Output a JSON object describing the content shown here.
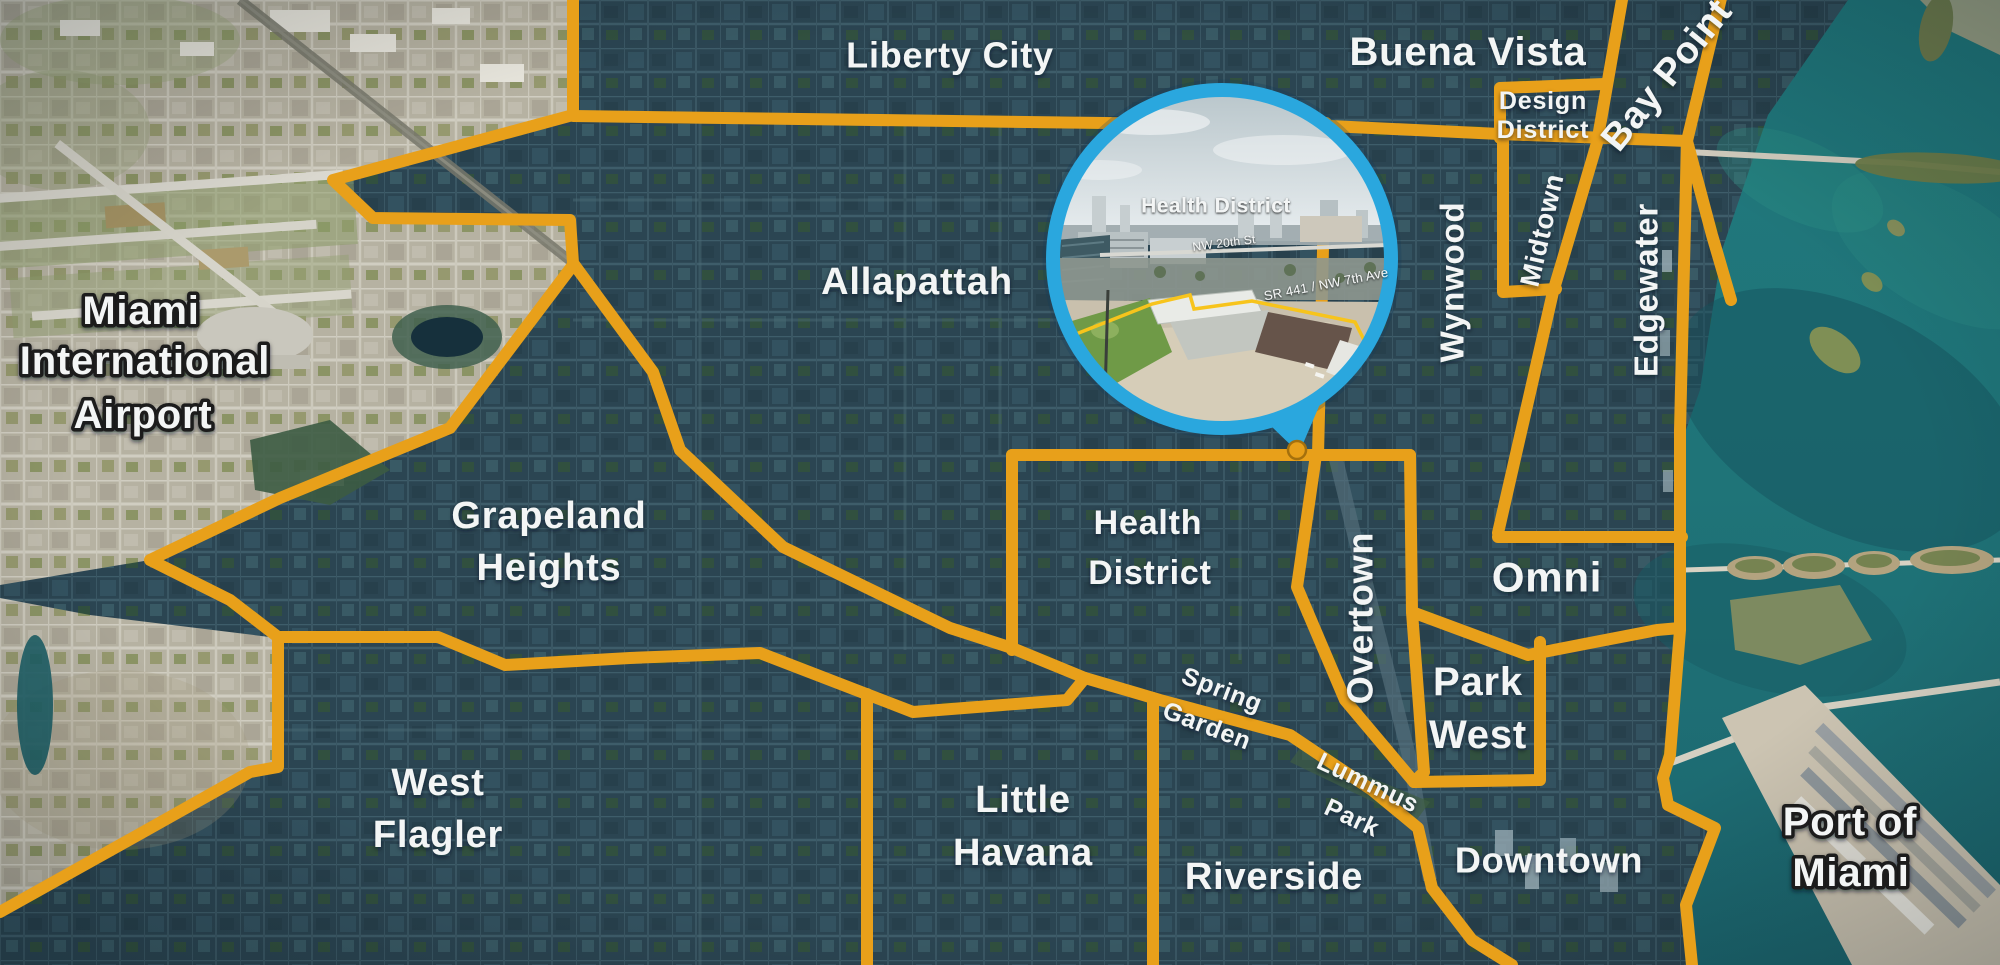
{
  "colors": {
    "boundary": "#E8A01A",
    "pin": "#E8A01A",
    "ring": "#2AA7DE",
    "parcel_outline": "#F7C41C",
    "label_text": "#F3F5F5",
    "water": "#1F7478",
    "city_dark": "#2B4552",
    "city_light": "#B6B2A2"
  },
  "map": {
    "region_labels": [
      {
        "id": "liberty-city",
        "text": "Liberty City",
        "x": 950,
        "y": 55,
        "size": 36,
        "rot": 0,
        "style": "plain"
      },
      {
        "id": "buena-vista",
        "text": "Buena Vista",
        "x": 1468,
        "y": 52,
        "size": 40,
        "rot": 0,
        "style": "plain"
      },
      {
        "id": "design-district-1",
        "text": "Design",
        "x": 1543,
        "y": 101,
        "size": 25,
        "rot": 0,
        "style": "plain"
      },
      {
        "id": "design-district-2",
        "text": "District",
        "x": 1543,
        "y": 130,
        "size": 25,
        "rot": 0,
        "style": "plain"
      },
      {
        "id": "bay-point",
        "text": "Bay Point",
        "x": 1667,
        "y": 75,
        "size": 38,
        "rot": -51,
        "style": "plain"
      },
      {
        "id": "midtown",
        "text": "Midtown",
        "x": 1542,
        "y": 230,
        "size": 27,
        "rot": -77,
        "style": "plain"
      },
      {
        "id": "wynwood",
        "text": "Wynwood",
        "x": 1452,
        "y": 282,
        "size": 33,
        "rot": -90,
        "style": "plain"
      },
      {
        "id": "edgewater",
        "text": "Edgewater",
        "x": 1646,
        "y": 290,
        "size": 33,
        "rot": -90,
        "style": "plain"
      },
      {
        "id": "allapattah",
        "text": "Allapattah",
        "x": 917,
        "y": 282,
        "size": 38,
        "rot": 0,
        "style": "plain"
      },
      {
        "id": "airport-1",
        "text": "Miami",
        "x": 141,
        "y": 311,
        "size": 40,
        "rot": 0,
        "style": "outlined"
      },
      {
        "id": "airport-2",
        "text": "International",
        "x": 145,
        "y": 361,
        "size": 40,
        "rot": 0,
        "style": "outlined"
      },
      {
        "id": "airport-3",
        "text": "Airport",
        "x": 143,
        "y": 415,
        "size": 40,
        "rot": 0,
        "style": "outlined"
      },
      {
        "id": "grapeland-1",
        "text": "Grapeland",
        "x": 549,
        "y": 516,
        "size": 38,
        "rot": 0,
        "style": "plain"
      },
      {
        "id": "grapeland-2",
        "text": "Heights",
        "x": 549,
        "y": 568,
        "size": 38,
        "rot": 0,
        "style": "plain"
      },
      {
        "id": "health-district-1",
        "text": "Health",
        "x": 1148,
        "y": 523,
        "size": 34,
        "rot": 0,
        "style": "plain"
      },
      {
        "id": "health-district-2",
        "text": "District",
        "x": 1150,
        "y": 573,
        "size": 34,
        "rot": 0,
        "style": "plain"
      },
      {
        "id": "overtown",
        "text": "Overtown",
        "x": 1360,
        "y": 618,
        "size": 36,
        "rot": -90,
        "style": "plain"
      },
      {
        "id": "omni",
        "text": "Omni",
        "x": 1547,
        "y": 577,
        "size": 42,
        "rot": 0,
        "style": "plain"
      },
      {
        "id": "park-west-1",
        "text": "Park",
        "x": 1478,
        "y": 682,
        "size": 40,
        "rot": 0,
        "style": "plain"
      },
      {
        "id": "park-west-2",
        "text": "West",
        "x": 1478,
        "y": 735,
        "size": 40,
        "rot": 0,
        "style": "plain"
      },
      {
        "id": "spring-garden-1",
        "text": "Spring",
        "x": 1222,
        "y": 690,
        "size": 25,
        "rot": 21,
        "style": "plain"
      },
      {
        "id": "spring-garden-2",
        "text": "Garden",
        "x": 1207,
        "y": 726,
        "size": 25,
        "rot": 21,
        "style": "plain"
      },
      {
        "id": "lummus-park-1",
        "text": "Lummus",
        "x": 1368,
        "y": 783,
        "size": 25,
        "rot": 25,
        "style": "plain"
      },
      {
        "id": "lummus-park-2",
        "text": "Park",
        "x": 1352,
        "y": 818,
        "size": 25,
        "rot": 25,
        "style": "plain"
      },
      {
        "id": "west-flagler-1",
        "text": "West",
        "x": 438,
        "y": 783,
        "size": 38,
        "rot": 0,
        "style": "plain"
      },
      {
        "id": "west-flagler-2",
        "text": "Flagler",
        "x": 438,
        "y": 835,
        "size": 38,
        "rot": 0,
        "style": "plain"
      },
      {
        "id": "little-havana-1",
        "text": "Little",
        "x": 1023,
        "y": 800,
        "size": 38,
        "rot": 0,
        "style": "plain"
      },
      {
        "id": "little-havana-2",
        "text": "Havana",
        "x": 1023,
        "y": 853,
        "size": 38,
        "rot": 0,
        "style": "plain"
      },
      {
        "id": "riverside",
        "text": "Riverside",
        "x": 1274,
        "y": 877,
        "size": 38,
        "rot": 0,
        "style": "plain"
      },
      {
        "id": "downtown",
        "text": "Downtown",
        "x": 1549,
        "y": 860,
        "size": 36,
        "rot": 0,
        "style": "plain"
      },
      {
        "id": "port-of-miami-1",
        "text": "Port of",
        "x": 1850,
        "y": 822,
        "size": 40,
        "rot": 0,
        "style": "outlined"
      },
      {
        "id": "port-of-miami-2",
        "text": "Miami",
        "x": 1851,
        "y": 873,
        "size": 40,
        "rot": 0,
        "style": "outlined"
      }
    ],
    "inset": {
      "labels": [
        {
          "id": "inset-health-district",
          "text": "Health District",
          "x": 1216,
          "y": 206,
          "size": 21,
          "rot": 0,
          "style": "inset-main"
        },
        {
          "id": "inset-nw-20th-st",
          "text": "NW 20th St",
          "x": 1224,
          "y": 243,
          "size": 12,
          "rot": -7,
          "style": "inset-small"
        },
        {
          "id": "inset-sr441",
          "text": "SR 441 / NW 7th Ave",
          "x": 1326,
          "y": 284,
          "size": 13,
          "rot": -11,
          "style": "inset-small"
        }
      ]
    }
  }
}
